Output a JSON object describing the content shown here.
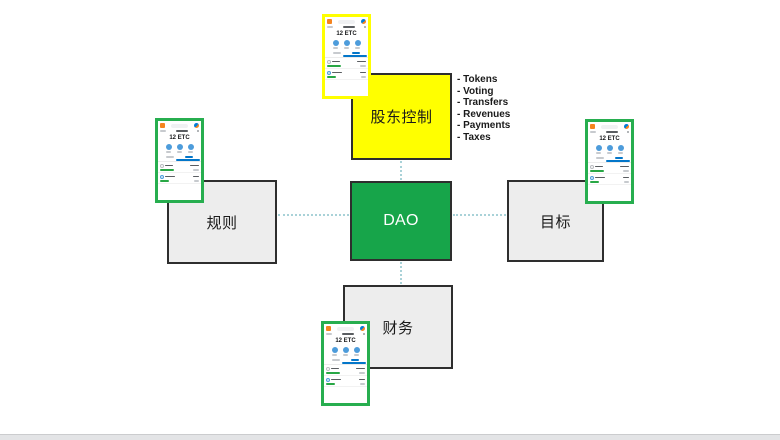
{
  "diagram": {
    "nodes": {
      "center": {
        "label": "DAO",
        "fill": "#17A54A",
        "text_color": "#FFFFFF"
      },
      "top": {
        "label": "股东控制",
        "fill": "#FFFF00",
        "text_color": "#1A1A1A"
      },
      "left": {
        "label": "规则",
        "fill": "#EDEDED",
        "text_color": "#1A1A1A"
      },
      "right": {
        "label": "目标",
        "fill": "#EDEDED",
        "text_color": "#1A1A1A"
      },
      "bottom": {
        "label": "财务",
        "fill": "#EDEDED",
        "text_color": "#1A1A1A"
      }
    },
    "annotation_list": [
      "- Tokens",
      "- Voting",
      "- Transfers",
      "- Revenues",
      "- Payments",
      "- Taxes"
    ],
    "connector_color": "#A9D2D8"
  },
  "wallet": {
    "balance": "12 ETC",
    "highlight_border_top": "#FFFF00",
    "highlight_border_sides": "#27AE4F",
    "brand_orange": "#F5841F",
    "action_blue": "#4D9CDB",
    "link_blue": "#0376C9",
    "tx_green": "#28A745"
  }
}
